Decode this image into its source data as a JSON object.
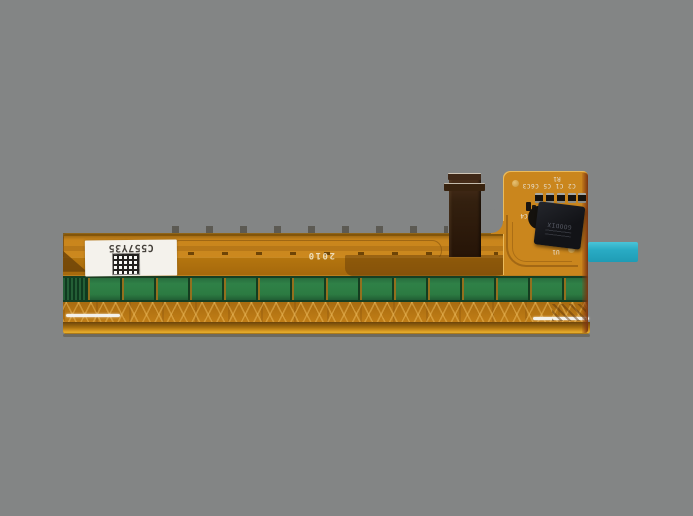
{
  "scene": {
    "description": "Photograph of a flexible printed circuit printhead module on a plain gray background",
    "background_color": "#838585"
  },
  "labels": {
    "serial": "C557Y35",
    "date_code": "2010",
    "silkscreen_r1": "R1",
    "silkscreen_caps": "C2 C1 C5 C6C3",
    "silkscreen_c4": "C4",
    "silkscreen_u1": "U1",
    "ic_marking": "GOODIX"
  },
  "colors": {
    "background": "#838585",
    "flex_orange": "#c9851c",
    "dark_trace_band": "#a5680c",
    "heater_green": "#2c7b42",
    "mesh_amber": "#c07d16",
    "bottom_edge_highlight": "#eab22e",
    "ribbon_brown": "#33200f",
    "ic_black": "#17171a",
    "label_white": "#f4f2ec",
    "connector_teal": "#29abc4",
    "gold_pad": "#d9ae52"
  }
}
